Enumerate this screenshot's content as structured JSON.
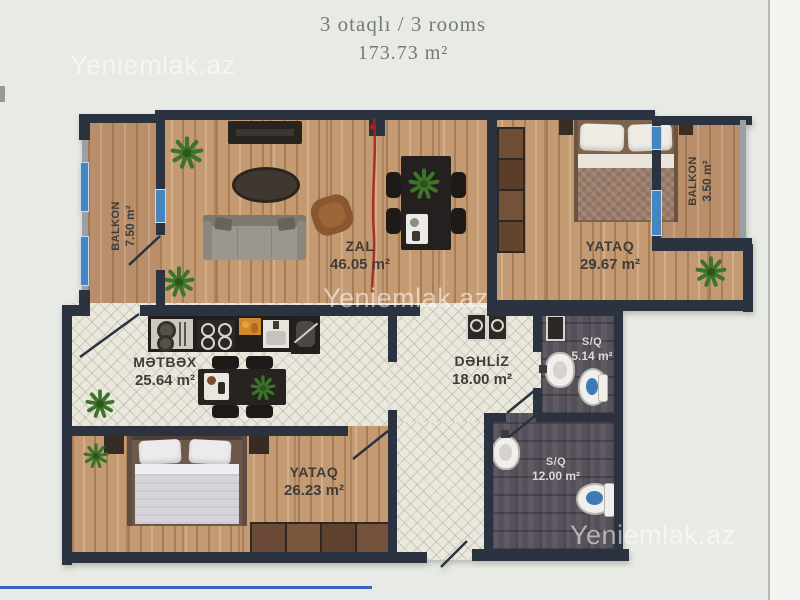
{
  "title": {
    "line1": "3 otaqlı / 3 rooms",
    "line2": "173.73 m²"
  },
  "watermark": {
    "text": "Yeniemlak.az"
  },
  "rooms": {
    "balkon_left": {
      "name": "BALKON",
      "area": "7.50 m²"
    },
    "zal": {
      "name": "ZAL",
      "area": "46.05 m²"
    },
    "yataq_top": {
      "name": "YATAQ",
      "area": "29.67 m²"
    },
    "balkon_right": {
      "name": "BALKON",
      "area": "3.50 m²"
    },
    "metbex": {
      "name": "MƏTBƏX",
      "area": "25.64 m²"
    },
    "dehliz": {
      "name": "DƏHLİZ",
      "area": "18.00 m²"
    },
    "sq_small": {
      "name": "S/Q",
      "area": "5.14 m²"
    },
    "sq_large": {
      "name": "S/Q",
      "area": "12.00 m²"
    },
    "yataq_bottom": {
      "name": "YATAQ",
      "area": "26.23 m²"
    }
  },
  "colors": {
    "wall": "#2a333f",
    "window": "#4585c0",
    "annotation_red": "#a32427",
    "pen_blue": "#3a63c4",
    "plant": "#3c7429",
    "plant_dark": "#2c551e",
    "label_dark": "#3f3d3a",
    "label_light": "#dad8d4",
    "title_gray": "#767b72"
  }
}
